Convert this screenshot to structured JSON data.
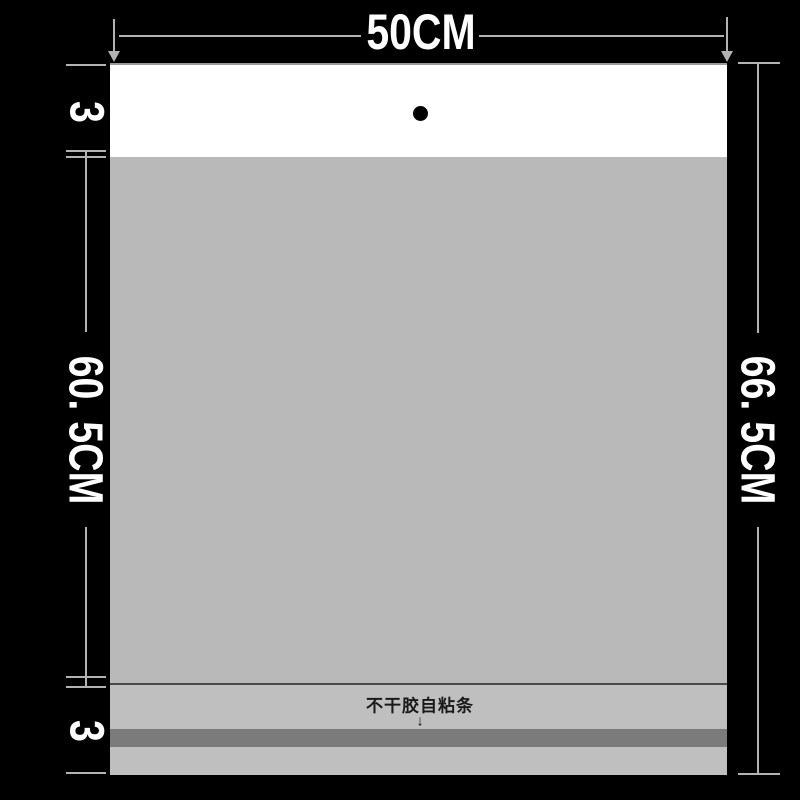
{
  "diagram": {
    "type": "packaging-dimension-diagram",
    "dimensions": {
      "width": "50CM",
      "top_flap": "3",
      "body_height": "60. 5CM",
      "bottom_flap": "3",
      "total_height": "66. 5CM"
    },
    "annotations": {
      "adhesive_strip_label": "不干胶自粘条",
      "adhesive_strip_arrow": "↓"
    },
    "colors": {
      "background": "#000000",
      "flap": "#ffffff",
      "body": "#b9b9b9",
      "bottom_section": "#bfbfbf",
      "adhesive_strip": "#7b7b7b",
      "fold_line": "#4a4a4a",
      "dimension_lines": "#b3b3b3",
      "dimension_text": "#ffffff",
      "annotation_text": "#1a1a1a",
      "hang_hole": "#000000",
      "bag_top_edge": "#9a9a9a"
    }
  }
}
